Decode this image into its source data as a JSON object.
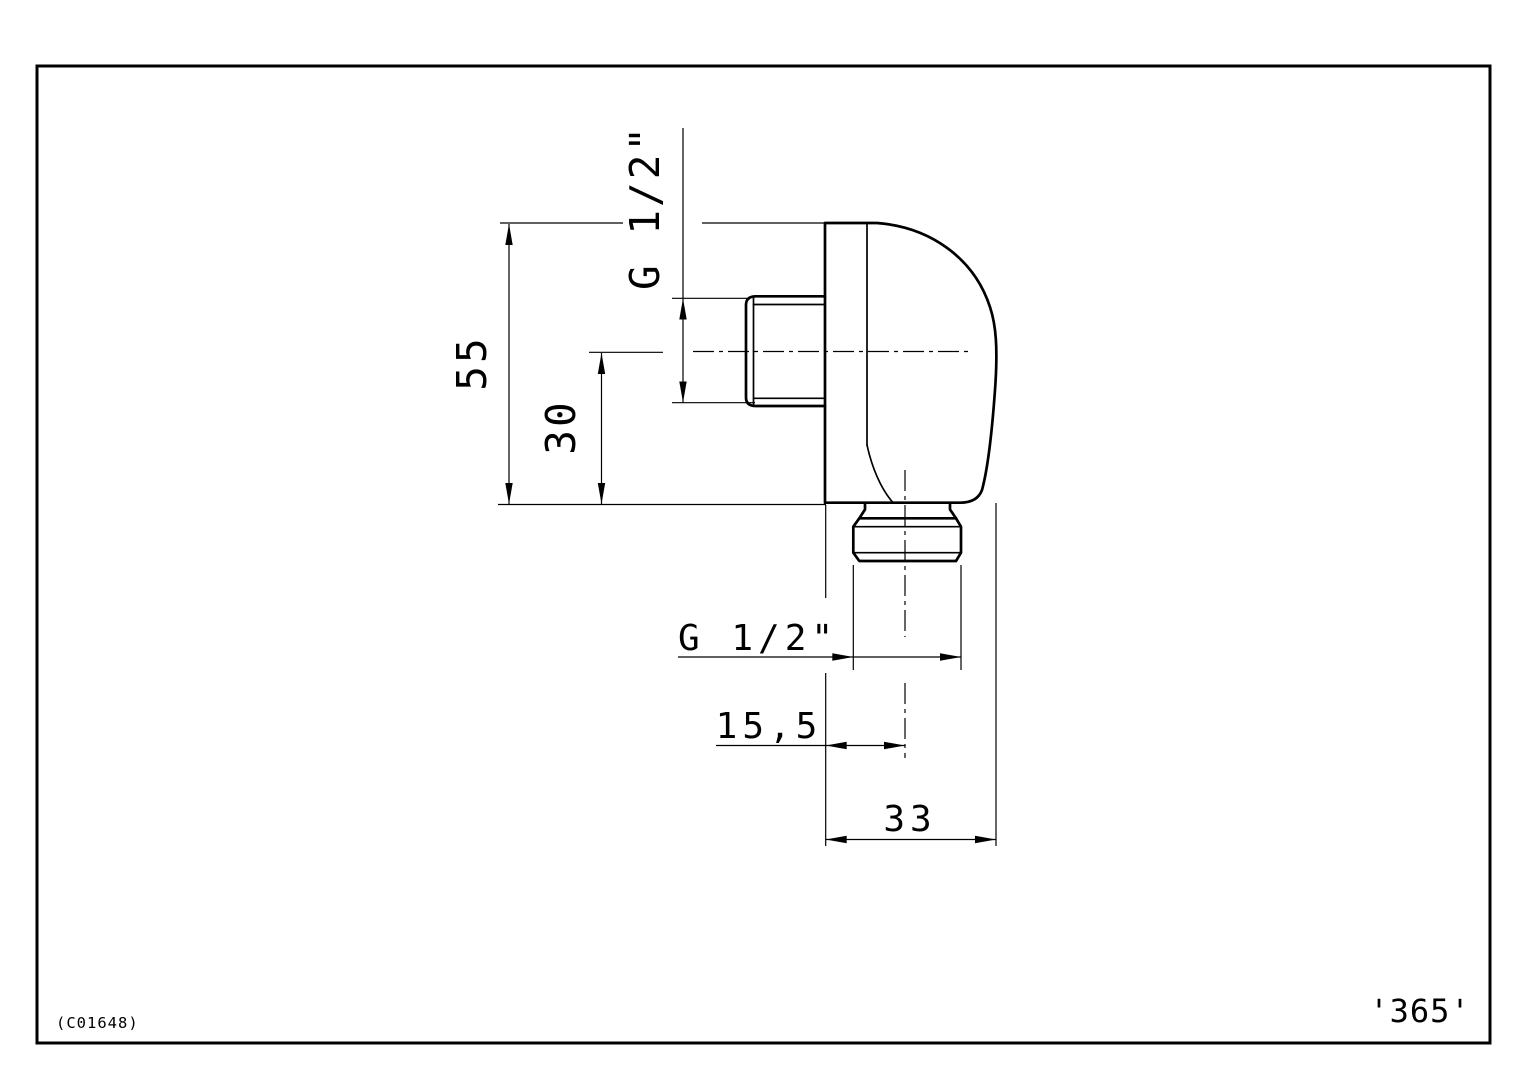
{
  "drawing": {
    "labels": {
      "thread_side": "G 1/2\"",
      "thread_bottom": "G 1/2\"",
      "height_total": "55",
      "height_to_center": "30",
      "offset_center": "15,5",
      "depth_total": "33",
      "doc_code": "(C01648)",
      "page_ref": "'365'"
    },
    "colors": {
      "line": "#000000",
      "background": "#ffffff"
    }
  }
}
